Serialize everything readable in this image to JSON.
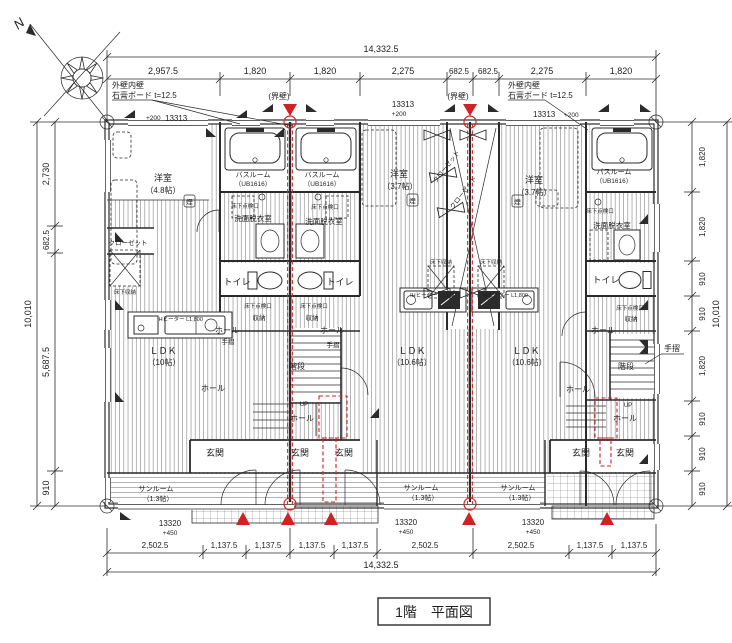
{
  "title": "1階　平面図",
  "compass": {
    "north": "N"
  },
  "dims": {
    "top": {
      "total": "14,332.5",
      "segments": [
        "2,957.5",
        "1,820",
        "1,820",
        "2,275",
        "682.5",
        "682.5",
        "2,275",
        "1,820"
      ]
    },
    "bottom": {
      "total": "14,332.5",
      "segments": [
        "2,502.5",
        "1,137.5",
        "1,137.5",
        "1,137.5",
        "1,137.5",
        "2,502.5",
        "2,502.5",
        "1,137.5",
        "1,137.5"
      ]
    },
    "left": {
      "total": "10,010",
      "segments": [
        "2,730",
        "682.5",
        "5,687.5",
        "910"
      ]
    },
    "right": {
      "total": "10,010",
      "segments": [
        "1,820",
        "1,820",
        "910",
        "910",
        "1,820",
        "910",
        "910",
        "910"
      ]
    }
  },
  "annotations": {
    "wall_note_line1": "外壁内壁",
    "wall_note_line2": "石膏ボード t=12.5",
    "party_wall": "(界壁)",
    "level_top": "13313",
    "level_top_offset": "+200",
    "level_bottom": "13320",
    "level_bottom_offset": "+450",
    "handrail": "手摺",
    "stairs": "階段",
    "up": "UP",
    "smoke_detector": "煙"
  },
  "rooms": {
    "yoshitsu48": "洋室",
    "yoshitsu48_size": "（4.8帖）",
    "yoshitsu37": "洋室",
    "yoshitsu37_size": "（3.7帖）",
    "bathroom": "バスルーム",
    "bathroom_size": "（UB1616）",
    "senmen": "洗面脱衣室",
    "toilet": "トイレ",
    "ldk10": "ＬＤＫ",
    "ldk10_size": "（10帖）",
    "ldk106": "ＬＤＫ",
    "ldk106_size": "（10.6帖）",
    "hall": "ホール",
    "genkan": "玄関",
    "sunroom": "サンルーム",
    "sunroom_size": "（1.3帖）",
    "closet": "クローゼット",
    "yukashita_shuno": "床下収納",
    "yukashita_tenken": "床下点検口",
    "shuno": "収納",
    "kitchen_label": "IHヒーター L1,800"
  },
  "colors": {
    "line": "#2b2b2b",
    "red": "#cf2222"
  }
}
